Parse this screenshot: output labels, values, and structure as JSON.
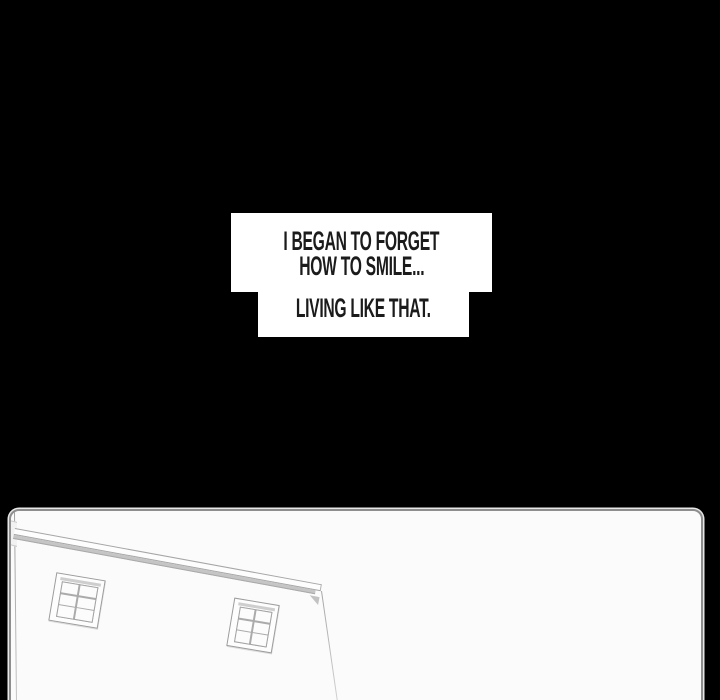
{
  "colors": {
    "page_bg": "#000000",
    "caption_box": "#ffffff",
    "caption_text": "#1b1b1b",
    "panel_bg": "#fbfbfb",
    "panel_border": "#8e8e8e",
    "line": "#a6a6a6",
    "eave_shadow": "#c5c5c5"
  },
  "caption": {
    "box_top": {
      "line1": "I BEGAN TO FORGET",
      "line2": "HOW TO SMILE..."
    },
    "box_bottom": {
      "line1": "LIVING LIKE THAT."
    }
  }
}
